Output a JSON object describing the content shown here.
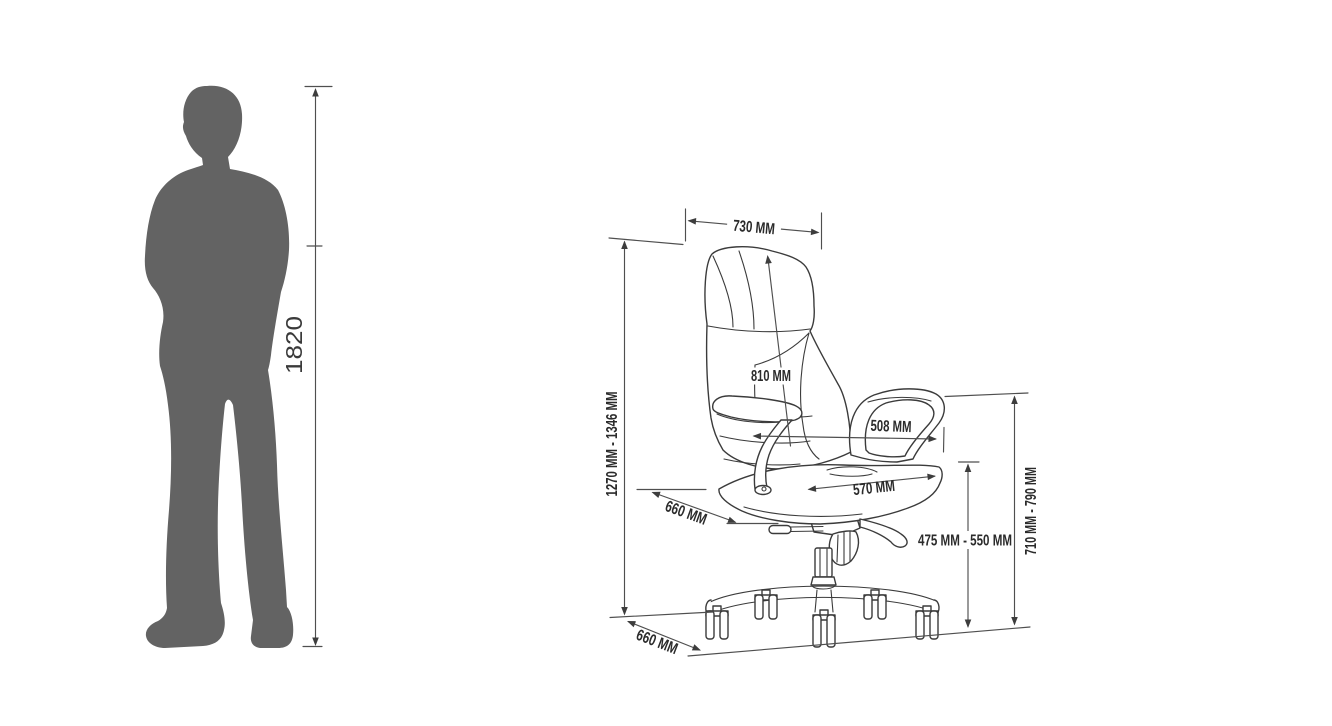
{
  "diagram": {
    "type": "product-dimension-diagram",
    "person": {
      "height_label": "1820",
      "silhouette_color": "#636363"
    },
    "chair": {
      "dimensions": {
        "top_width": "730 MM",
        "backrest_height": "810 MM",
        "armrest_span": "508 MM",
        "seat_width": "570 MM",
        "seat_depth": "660 MM",
        "base_depth": "660 MM",
        "seat_height_range": "475 MM - 550 MM",
        "armrest_height_range": "710 MM - 790 MM",
        "overall_height_range": "1270 MM - 1346 MM"
      }
    },
    "colors": {
      "background": "#ffffff",
      "line_art": "#3b3b3b",
      "dimension_lines": "#4f4f4f",
      "label_text": "#2b2b2b"
    }
  }
}
